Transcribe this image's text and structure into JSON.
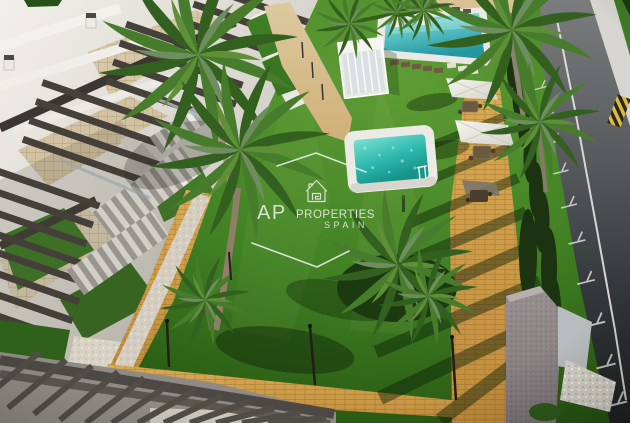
{
  "watermark": {
    "brand_initials": "AP",
    "brand_name": "PROPERTIES",
    "brand_region": "SPAIN",
    "logo": "house-spiral-icon"
  },
  "colors": {
    "lawn_light": "#5f9e35",
    "lawn": "#418124",
    "lawn_dark": "#1d430b",
    "pool_water": "#2fb9ae",
    "pool_water_light": "#a9e4e2",
    "pool_deck": "#eae8e2",
    "path_brick": "#d2a24c",
    "path_sand": "#d8c193",
    "road_light": "#7a7c7e",
    "road_dark": "#26282a",
    "building_white": "#ece9e3",
    "terrace_tan": "#d7c7a7",
    "pergola_wood": "#46413b",
    "cypress": "#1b3310",
    "palm": "#3d6b2a",
    "watermark": "#e9efe8"
  }
}
